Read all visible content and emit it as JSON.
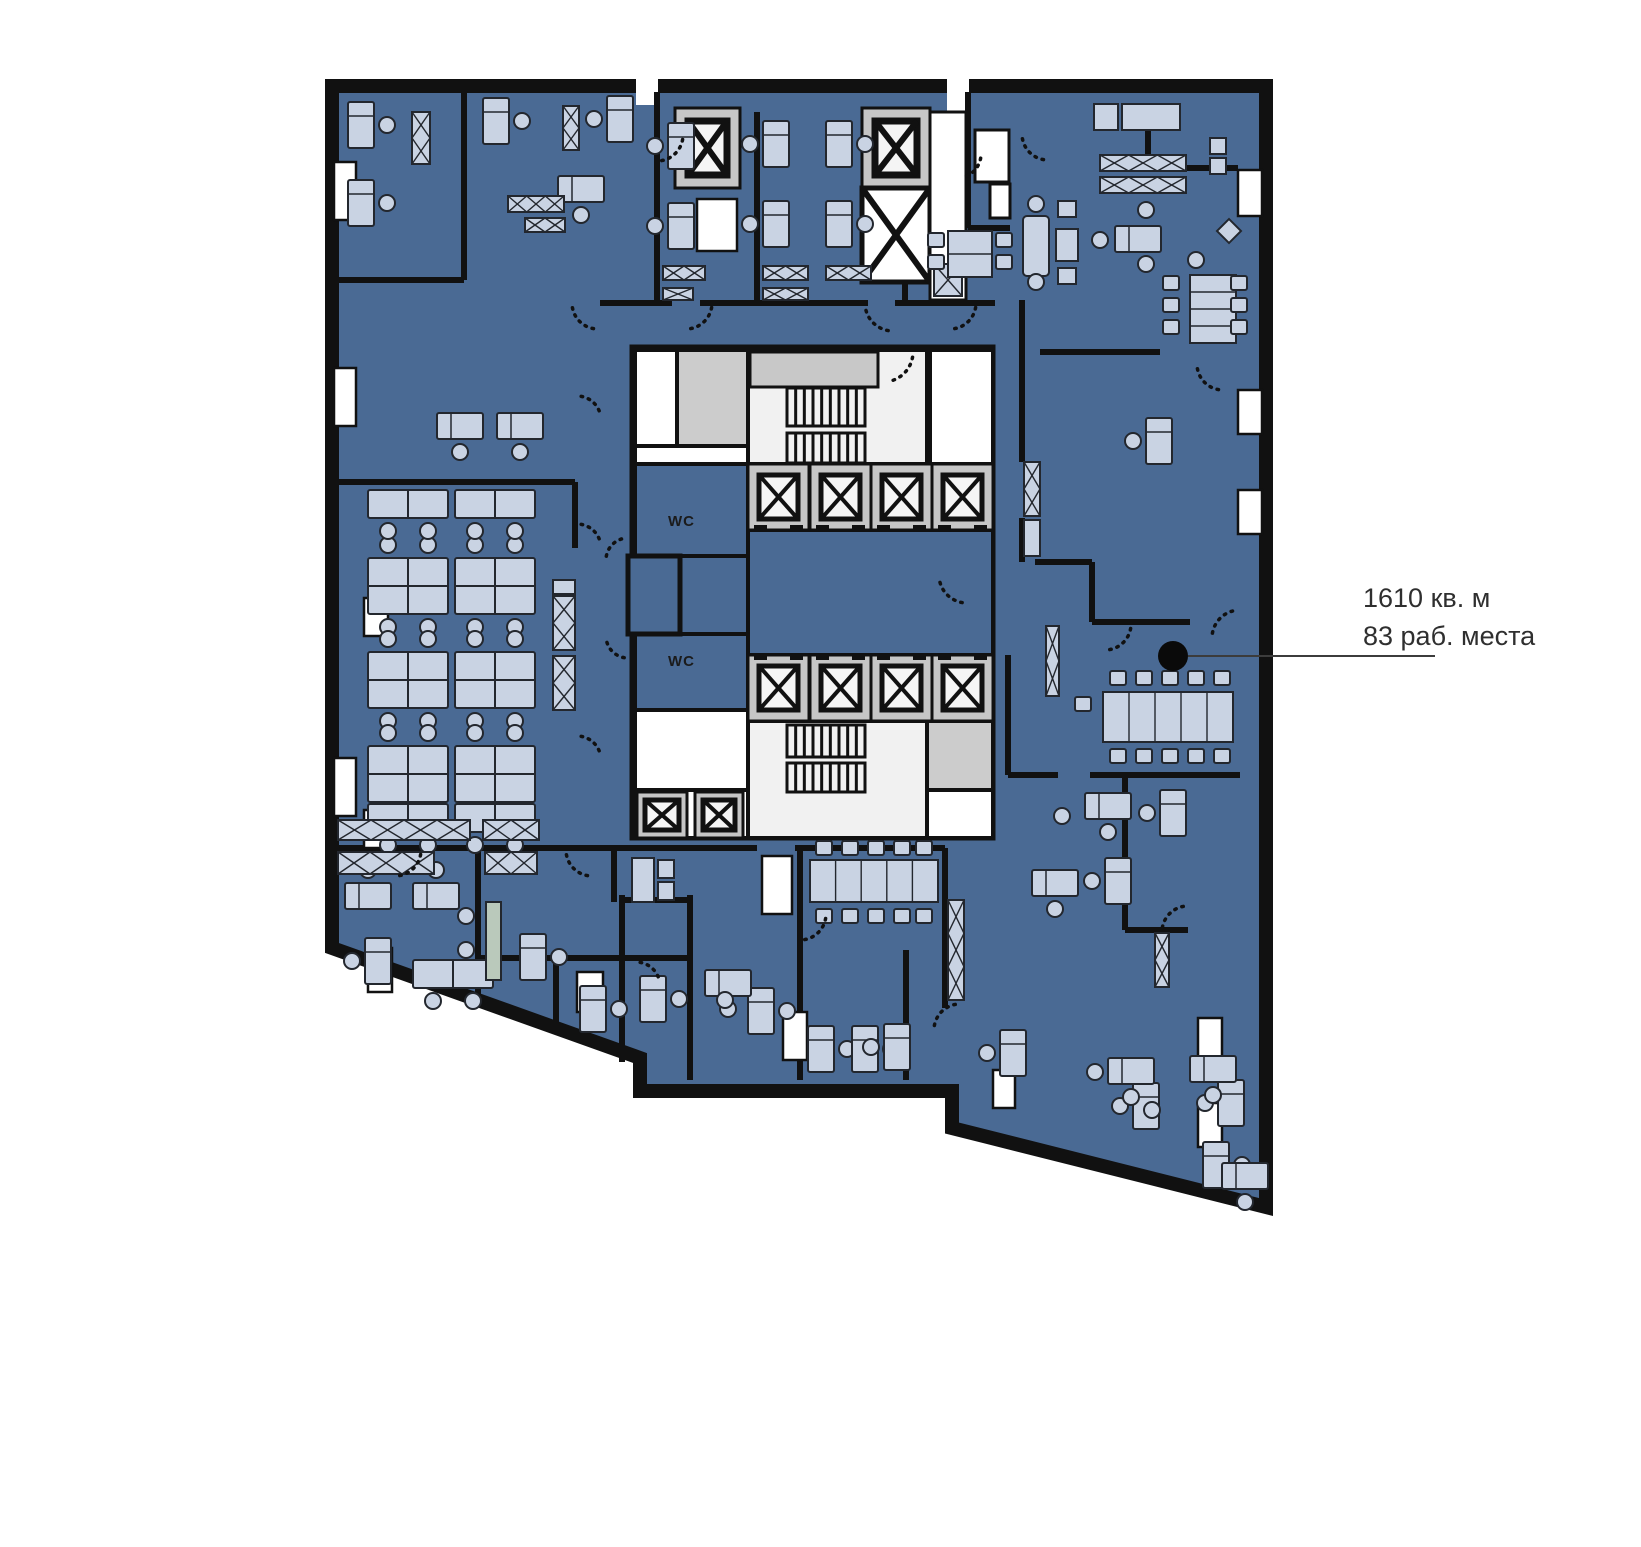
{
  "labels": {
    "wc": "WC",
    "area": "1610 кв. м",
    "places": "83 раб. места"
  },
  "colors": {
    "floor": "#4a6a94",
    "wall": "#111111",
    "furn": "#c9d3e3",
    "furnStroke": "#23272e",
    "white": "#ffffff",
    "hall": "#f1f1f1",
    "gray": "#cccccc",
    "liftSurround": "#c6c6c6",
    "liftCab": "#f5f5f5",
    "green": "#bac9bb",
    "leader": "#3c3c3c",
    "dot": "#0a0a0a"
  },
  "plan": {
    "width": 1641,
    "height": 1547,
    "shell": [
      [
        332,
        86
      ],
      [
        1266,
        86
      ],
      [
        1266,
        1207
      ],
      [
        952,
        1128
      ],
      [
        952,
        1091
      ],
      [
        640,
        1091
      ],
      [
        640,
        1058
      ],
      [
        332,
        948
      ]
    ],
    "notches": [
      [
        636,
        77,
        22,
        28
      ],
      [
        947,
        77,
        22,
        42
      ]
    ],
    "windows": [
      [
        334,
        162,
        22,
        58
      ],
      [
        334,
        368,
        22,
        58
      ],
      [
        364,
        598,
        24,
        38
      ],
      [
        334,
        758,
        22,
        58
      ],
      [
        364,
        810,
        22,
        38
      ],
      [
        368,
        948,
        24,
        44
      ],
      [
        577,
        972,
        26,
        40
      ],
      [
        783,
        1012,
        24,
        48
      ],
      [
        993,
        1070,
        22,
        38
      ],
      [
        1238,
        170,
        24,
        46
      ],
      [
        1238,
        390,
        24,
        44
      ],
      [
        1238,
        490,
        24,
        44
      ],
      [
        1198,
        1018,
        24,
        44
      ],
      [
        1198,
        1103,
        24,
        44
      ],
      [
        762,
        856,
        30,
        58
      ],
      [
        697,
        199,
        40,
        52
      ]
    ],
    "walls": [
      [
        464,
        92,
        464,
        280
      ],
      [
        338,
        280,
        464,
        280
      ],
      [
        338,
        482,
        575,
        482
      ],
      [
        575,
        482,
        575,
        548
      ],
      [
        338,
        848,
        757,
        848
      ],
      [
        795,
        848,
        945,
        848
      ],
      [
        478,
        848,
        478,
        1000
      ],
      [
        478,
        958,
        690,
        958
      ],
      [
        556,
        958,
        556,
        1032
      ],
      [
        622,
        895,
        622,
        1062
      ],
      [
        614,
        848,
        614,
        902
      ],
      [
        657,
        92,
        657,
        303
      ],
      [
        757,
        112,
        757,
        303
      ],
      [
        905,
        112,
        905,
        303
      ],
      [
        600,
        303,
        672,
        303
      ],
      [
        700,
        303,
        868,
        303
      ],
      [
        895,
        303,
        995,
        303
      ],
      [
        968,
        92,
        968,
        228
      ],
      [
        968,
        228,
        1010,
        228
      ],
      [
        1148,
        112,
        1148,
        168
      ],
      [
        1130,
        168,
        1238,
        168
      ],
      [
        1022,
        300,
        1022,
        462
      ],
      [
        1022,
        518,
        1022,
        562
      ],
      [
        1040,
        352,
        1160,
        352
      ],
      [
        1035,
        562,
        1092,
        562
      ],
      [
        1092,
        562,
        1092,
        622
      ],
      [
        1092,
        622,
        1190,
        622
      ],
      [
        800,
        848,
        800,
        1080
      ],
      [
        945,
        848,
        945,
        1008
      ],
      [
        906,
        950,
        906,
        1080
      ],
      [
        690,
        895,
        690,
        1080
      ],
      [
        622,
        900,
        690,
        900
      ],
      [
        1008,
        655,
        1008,
        775
      ],
      [
        1008,
        775,
        1058,
        775
      ],
      [
        1090,
        775,
        1240,
        775
      ],
      [
        1125,
        775,
        1125,
        930
      ],
      [
        1125,
        930,
        1188,
        930
      ]
    ],
    "core": {
      "outer": [
        632,
        347,
        361,
        491
      ],
      "whiteRooms": [
        [
          635,
          350,
          42,
          96
        ],
        [
          635,
          446,
          113,
          18
        ],
        [
          635,
          710,
          113,
          80
        ],
        [
          930,
          350,
          63,
          114
        ],
        [
          927,
          790,
          66,
          48
        ],
        [
          635,
          790,
          113,
          48
        ]
      ],
      "grayRooms": [
        [
          677,
          350,
          71,
          96
        ],
        [
          927,
          721,
          66,
          69
        ]
      ],
      "halls": [
        [
          748,
          350,
          179,
          114
        ],
        [
          748,
          721,
          179,
          117
        ]
      ],
      "grayBand": [
        750,
        352,
        128,
        35
      ],
      "blueRooms": [
        [
          635,
          464,
          113,
          92
        ],
        [
          635,
          556,
          113,
          78
        ],
        [
          635,
          634,
          113,
          76
        ],
        [
          748,
          530,
          245,
          125
        ]
      ],
      "vestibule": [
        628,
        556,
        52,
        78
      ],
      "wcText": [
        [
          668,
          526
        ],
        [
          668,
          666
        ]
      ]
    },
    "stairs": [
      {
        "x": 787,
        "w": 78,
        "bands": [
          [
            388,
            426
          ],
          [
            433,
            463
          ]
        ],
        "n": 9
      },
      {
        "x": 787,
        "w": 78,
        "bands": [
          [
            725,
            757
          ],
          [
            763,
            792
          ]
        ],
        "n": 9
      }
    ],
    "lifts": {
      "rows": [
        {
          "y": 464,
          "h": 66,
          "w": 61,
          "xs": [
            748,
            810,
            871,
            932
          ],
          "door": "b"
        },
        {
          "y": 655,
          "h": 66,
          "w": 61,
          "xs": [
            748,
            810,
            871,
            932
          ],
          "door": "t"
        }
      ],
      "small": [
        [
          637,
          792,
          50,
          46
        ],
        [
          695,
          792,
          48,
          46
        ]
      ],
      "top": [
        [
          675,
          108,
          65,
          80
        ],
        [
          862,
          108,
          68,
          80
        ]
      ],
      "vent": [
        862,
        188,
        68,
        94
      ],
      "strip": [
        930,
        112,
        36,
        188
      ],
      "shaftWhite": [
        [
          975,
          130,
          34,
          52
        ],
        [
          990,
          184,
          20,
          34
        ]
      ]
    },
    "furniture": {
      "desksV": [
        [
          348,
          102,
          "r"
        ],
        [
          348,
          180,
          "r"
        ],
        [
          483,
          98,
          "r"
        ],
        [
          607,
          96,
          "l"
        ],
        [
          668,
          123,
          "l"
        ],
        [
          668,
          203,
          "l"
        ],
        [
          763,
          121,
          "l"
        ],
        [
          826,
          121,
          "r"
        ],
        [
          763,
          201,
          "l"
        ],
        [
          826,
          201,
          "r"
        ],
        [
          1146,
          418,
          "l"
        ],
        [
          1160,
          790,
          "l"
        ],
        [
          1105,
          858,
          "l"
        ],
        [
          580,
          986,
          "r"
        ],
        [
          640,
          976,
          "r"
        ],
        [
          748,
          988,
          "r"
        ],
        [
          808,
          1026,
          "r"
        ],
        [
          852,
          1026,
          "r"
        ],
        [
          884,
          1024,
          "l"
        ],
        [
          1133,
          1083,
          "l"
        ],
        [
          1218,
          1080,
          "l"
        ],
        [
          1203,
          1142,
          "r"
        ],
        [
          1000,
          1030,
          "l"
        ],
        [
          520,
          934,
          "r"
        ],
        [
          365,
          938,
          "l"
        ]
      ],
      "desksH": [
        [
          558,
          176,
          "b"
        ],
        [
          437,
          413,
          "b"
        ],
        [
          497,
          413,
          "b"
        ],
        [
          345,
          883,
          "t"
        ],
        [
          413,
          883,
          "t"
        ],
        [
          705,
          970,
          "b"
        ],
        [
          1085,
          793,
          "b"
        ],
        [
          1032,
          870,
          "b"
        ],
        [
          1108,
          1058,
          "b"
        ],
        [
          1190,
          1056,
          "b"
        ],
        [
          1222,
          1163,
          "b"
        ],
        [
          1115,
          226,
          "n"
        ]
      ],
      "clusters4": [
        [
          368,
          558
        ],
        [
          455,
          558
        ],
        [
          368,
          652
        ],
        [
          455,
          652
        ],
        [
          368,
          746
        ],
        [
          455,
          746
        ]
      ],
      "clusters2": [
        [
          368,
          490
        ],
        [
          455,
          490
        ],
        [
          368,
          804
        ],
        [
          455,
          804
        ],
        [
          413,
          960
        ]
      ],
      "xshelves": [
        [
          412,
          112,
          18,
          52,
          2,
          "v"
        ],
        [
          563,
          106,
          16,
          44,
          2,
          "v"
        ],
        [
          508,
          196,
          56,
          16,
          3,
          "h"
        ],
        [
          525,
          218,
          40,
          14,
          2,
          "h"
        ],
        [
          663,
          266,
          42,
          14,
          2,
          "h"
        ],
        [
          663,
          288,
          30,
          12,
          1,
          "h"
        ],
        [
          763,
          266,
          45,
          14,
          2,
          "h"
        ],
        [
          826,
          266,
          45,
          14,
          2,
          "h"
        ],
        [
          763,
          288,
          45,
          12,
          2,
          "h"
        ],
        [
          553,
          596,
          22,
          54,
          2,
          "v"
        ],
        [
          553,
          656,
          22,
          54,
          2,
          "v"
        ],
        [
          1024,
          462,
          16,
          54,
          2,
          "v"
        ],
        [
          1046,
          626,
          13,
          70,
          2,
          "v"
        ],
        [
          1100,
          155,
          86,
          16,
          3,
          "h"
        ],
        [
          1100,
          177,
          86,
          16,
          3,
          "h"
        ],
        [
          338,
          820,
          132,
          20,
          4,
          "h"
        ],
        [
          483,
          820,
          56,
          20,
          2,
          "h"
        ],
        [
          338,
          852,
          96,
          22,
          3,
          "h"
        ],
        [
          485,
          852,
          52,
          22,
          2,
          "h"
        ],
        [
          934,
          264,
          28,
          32,
          1,
          "v"
        ],
        [
          1155,
          933,
          14,
          54,
          2,
          "v"
        ],
        [
          948,
          900,
          16,
          100,
          3,
          "v"
        ]
      ],
      "cabinets": [
        [
          632,
          858,
          22,
          44
        ],
        [
          658,
          860,
          16,
          18
        ],
        [
          658,
          882,
          16,
          18
        ],
        [
          1024,
          520,
          16,
          36
        ],
        [
          553,
          580,
          22,
          14
        ],
        [
          1122,
          104,
          58,
          26
        ],
        [
          1094,
          104,
          24,
          26
        ],
        [
          1210,
          138,
          16,
          16
        ],
        [
          1210,
          158,
          16,
          16
        ]
      ],
      "green": [
        [
          486,
          902,
          15,
          78
        ]
      ],
      "sofas": [
        [
          1023,
          216,
          26,
          60
        ]
      ],
      "circles": [
        [
          1036,
          204,
          8
        ],
        [
          1036,
          282,
          8
        ]
      ],
      "squares": [
        [
          1058,
          201,
          18,
          16
        ],
        [
          1056,
          229,
          22,
          32
        ],
        [
          1058,
          268,
          18,
          16
        ]
      ],
      "diamonds": [
        [
          1229,
          231,
          17
        ]
      ],
      "chairs": [
        [
          1100,
          240
        ],
        [
          1146,
          210
        ],
        [
          1146,
          264
        ],
        [
          1196,
          260
        ],
        [
          466,
          916
        ],
        [
          466,
          950
        ],
        [
          1062,
          816
        ],
        [
          1095,
          1072
        ],
        [
          1152,
          1110
        ],
        [
          725,
          1000
        ]
      ],
      "meeting": [
        {
          "type": "h",
          "x": 1103,
          "y": 692,
          "w": 130,
          "h": 50,
          "cols": 5,
          "top": [
            1110,
            1136,
            1162,
            1188,
            1214
          ],
          "ty": 671,
          "bottom": [
            1110,
            1136,
            1162,
            1188,
            1214
          ],
          "by": 749,
          "extra": [
            [
              1083,
              704
            ]
          ]
        },
        {
          "type": "h",
          "x": 810,
          "y": 860,
          "w": 128,
          "h": 42,
          "cols": 5,
          "top": [
            816,
            842,
            868,
            894,
            916
          ],
          "ty": 841,
          "bottom": [
            816,
            842,
            868,
            894,
            916
          ],
          "by": 909,
          "extra": []
        },
        {
          "type": "v",
          "x": 1190,
          "y": 275,
          "w": 46,
          "h": 68,
          "rows": 4,
          "left": [
            283,
            305,
            327
          ],
          "lx": 1171,
          "right": [
            283,
            305,
            327
          ],
          "rx": 1239,
          "extra": []
        },
        {
          "type": "v",
          "x": 948,
          "y": 231,
          "w": 44,
          "h": 46,
          "rows": 2,
          "left": [
            240,
            262
          ],
          "lx": 936,
          "right": [
            240,
            262
          ],
          "rx": 1004,
          "extra": []
        }
      ]
    },
    "arcs": [
      [
        657,
        135,
        26,
        10,
        80
      ],
      [
        598,
        303,
        26,
        100,
        170
      ],
      [
        686,
        303,
        26,
        10,
        80
      ],
      [
        893,
        303,
        28,
        100,
        170
      ],
      [
        950,
        303,
        26,
        10,
        80
      ],
      [
        883,
        352,
        30,
        10,
        80
      ],
      [
        967,
        575,
        28,
        100,
        170
      ],
      [
        628,
        560,
        22,
        190,
        260
      ],
      [
        628,
        636,
        22,
        100,
        170
      ],
      [
        577,
        420,
        24,
        280,
        350
      ],
      [
        577,
        548,
        24,
        280,
        350
      ],
      [
        577,
        760,
        24,
        280,
        350
      ],
      [
        1105,
        624,
        26,
        10,
        80
      ],
      [
        1240,
        638,
        28,
        190,
        260
      ],
      [
        1223,
        364,
        26,
        100,
        170
      ],
      [
        1048,
        134,
        26,
        100,
        170
      ],
      [
        957,
        154,
        24,
        10,
        80
      ],
      [
        395,
        850,
        26,
        10,
        80
      ],
      [
        592,
        850,
        26,
        100,
        170
      ],
      [
        636,
        986,
        24,
        280,
        350
      ],
      [
        960,
        1030,
        26,
        190,
        260
      ],
      [
        1188,
        932,
        26,
        190,
        260
      ],
      [
        800,
        914,
        26,
        10,
        80
      ]
    ],
    "annotation": {
      "dot": [
        1173,
        656,
        15
      ],
      "line": [
        1188,
        656,
        1435,
        656
      ]
    }
  }
}
